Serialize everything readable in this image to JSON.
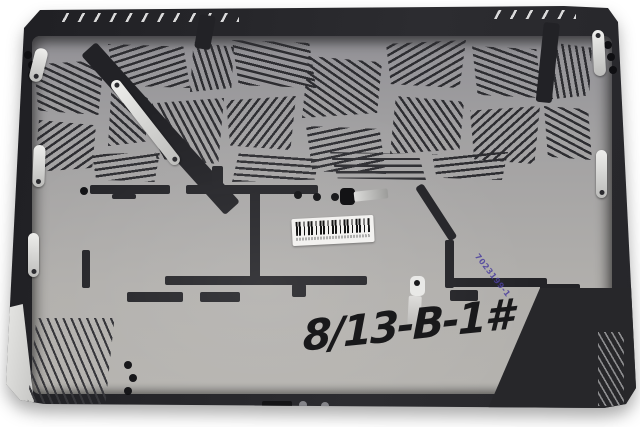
{
  "markings": {
    "handwritten_label": "8/13-B-1#",
    "stamp_code": "7023199-1",
    "stamp_color": "#4b3f9e",
    "barcode_label": {
      "bars_color": "#141414",
      "background": "#f3f2f0",
      "text_legible": false
    }
  },
  "colors": {
    "photo_background": "#ffffff",
    "case_rim": "#232327",
    "inner_surface": "#a9a7a5",
    "vent_slots": "#2d2d31",
    "bracket_metal": "#dcdcda"
  }
}
